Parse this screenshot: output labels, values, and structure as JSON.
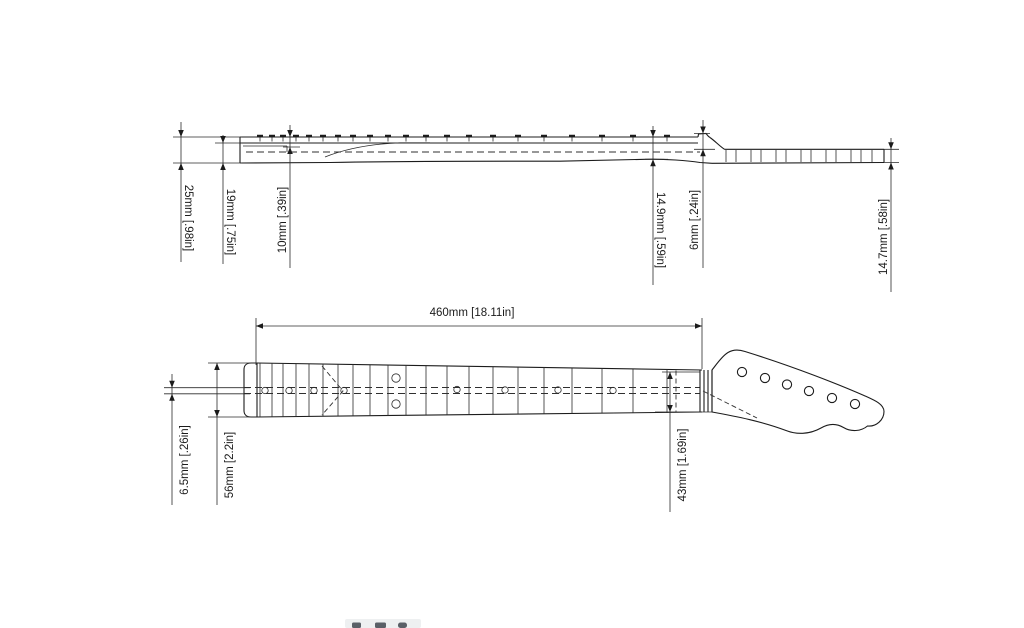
{
  "page": {
    "background": "#ffffff",
    "line_color": "#1c1c1c"
  },
  "side_view": {
    "dimensions": [
      {
        "label": "25mm [.98in]",
        "value_mm": 25,
        "value_in": 0.98
      },
      {
        "label": "19mm [.75in]",
        "value_mm": 19,
        "value_in": 0.75
      },
      {
        "label": "10mm [.39in]",
        "value_mm": 10,
        "value_in": 0.39
      },
      {
        "label": "14.9mm [.59in]",
        "value_mm": 14.9,
        "value_in": 0.59
      },
      {
        "label": "6mm [.24in]",
        "value_mm": 6,
        "value_in": 0.24
      },
      {
        "label": "14.7mm [.58in]",
        "value_mm": 14.7,
        "value_in": 0.58
      }
    ]
  },
  "plan_view": {
    "dimensions": [
      {
        "label": "460mm [18.11in]",
        "value_mm": 460,
        "value_in": 18.11
      },
      {
        "label": "6.5mm [.26in]",
        "value_mm": 6.5,
        "value_in": 0.26
      },
      {
        "label": "56mm [2.2in]",
        "value_mm": 56,
        "value_in": 2.2
      },
      {
        "label": "43mm [1.69in]",
        "value_mm": 43,
        "value_in": 1.69
      }
    ]
  }
}
